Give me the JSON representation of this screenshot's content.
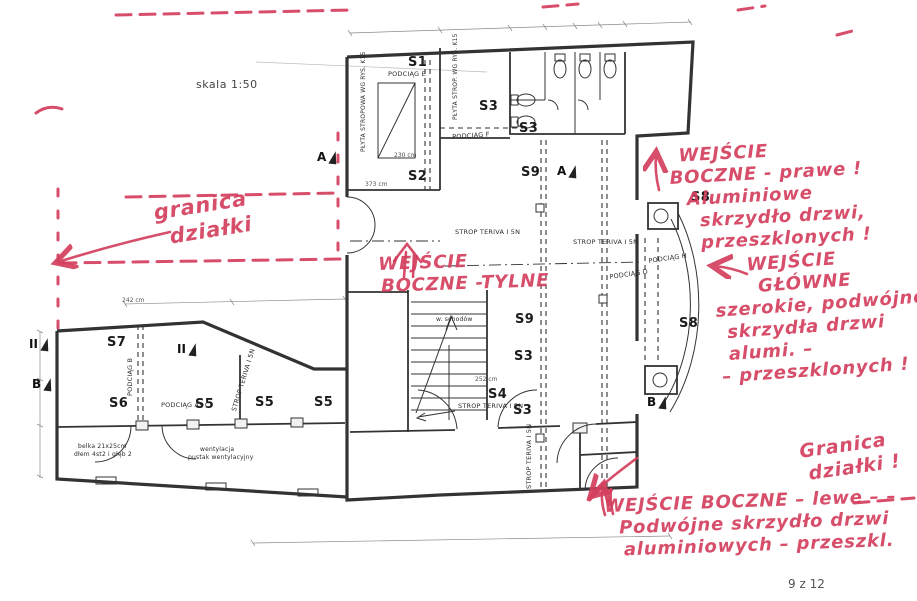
{
  "meta": {
    "scale_label": "skala 1:50",
    "page_number": "9 z 12"
  },
  "colors": {
    "marker_red": "#d43f5e",
    "ink": "#333333",
    "paper": "#ffffff"
  },
  "plan": {
    "room_labels": [
      {
        "label": "S1",
        "x": 408,
        "y": 55
      },
      {
        "label": "S2",
        "x": 408,
        "y": 169
      },
      {
        "label": "S3",
        "x": 479,
        "y": 99
      },
      {
        "label": "S3",
        "x": 519,
        "y": 121
      },
      {
        "label": "S9",
        "x": 521,
        "y": 165
      },
      {
        "label": "S9",
        "x": 515,
        "y": 312
      },
      {
        "label": "S3",
        "x": 514,
        "y": 349
      },
      {
        "label": "S4",
        "x": 488,
        "y": 387
      },
      {
        "label": "S3",
        "x": 513,
        "y": 403
      },
      {
        "label": "S8",
        "x": 691,
        "y": 190
      },
      {
        "label": "S8",
        "x": 679,
        "y": 316
      },
      {
        "label": "S7",
        "x": 107,
        "y": 335
      },
      {
        "label": "S6",
        "x": 109,
        "y": 396
      },
      {
        "label": "S5",
        "x": 195,
        "y": 397
      },
      {
        "label": "S5",
        "x": 255,
        "y": 395
      },
      {
        "label": "S5",
        "x": 314,
        "y": 395
      }
    ],
    "tech_labels": [
      {
        "text": "PODCIĄG E",
        "x": 388,
        "y": 70
      },
      {
        "text": "PODCIĄG F",
        "x": 452,
        "y": 133,
        "rotate": -4
      },
      {
        "text": "PŁYTA STROPOWA WG RYS. K15",
        "x": 360,
        "y": 152,
        "rotate": -90,
        "size": 6
      },
      {
        "text": "PŁYTA STROP. WG RYS. K15",
        "x": 452,
        "y": 120,
        "rotate": -90,
        "size": 6
      },
      {
        "text": "PODCIĄG B",
        "x": 126,
        "y": 396,
        "rotate": -90
      },
      {
        "text": "PODCIĄG A+C",
        "x": 161,
        "y": 401
      },
      {
        "text": "STROP TERIVA I 5N",
        "x": 230,
        "y": 410,
        "rotate": -73
      },
      {
        "text": "STROP TERIVA I 5N",
        "x": 455,
        "y": 228
      },
      {
        "text": "STROP TERIVA I 5N",
        "x": 573,
        "y": 238
      },
      {
        "text": "STROP TERIVA I 5N",
        "x": 458,
        "y": 402
      },
      {
        "text": "STROP TERIVA I 5N",
        "x": 525,
        "y": 489,
        "rotate": -90
      },
      {
        "text": "PODCIĄG D",
        "x": 609,
        "y": 273,
        "rotate": -8
      },
      {
        "text": "PODCIĄG H",
        "x": 648,
        "y": 257,
        "rotate": -8
      },
      {
        "text": "w. schodów",
        "x": 436,
        "y": 316,
        "size": 6
      },
      {
        "text": "wentylacja",
        "x": 200,
        "y": 446,
        "size": 6
      },
      {
        "text": "pustak wentylacyjny",
        "x": 188,
        "y": 454,
        "size": 6
      },
      {
        "text": "belka 21x25cm",
        "x": 78,
        "y": 443,
        "size": 6
      },
      {
        "text": "dłem 4st2 i głęb 2",
        "x": 74,
        "y": 451,
        "size": 6
      }
    ],
    "dim_labels": [
      {
        "text": "242 cm",
        "x": 122,
        "y": 297
      },
      {
        "text": "230 cm",
        "x": 394,
        "y": 152
      },
      {
        "text": "373 cm",
        "x": 365,
        "y": 181
      },
      {
        "text": "252 cm",
        "x": 475,
        "y": 376
      }
    ],
    "section_markers": [
      {
        "label": "A",
        "x": 317,
        "y": 150
      },
      {
        "label": "A",
        "x": 557,
        "y": 164
      },
      {
        "label": "II",
        "x": 29,
        "y": 337
      },
      {
        "label": "II",
        "x": 177,
        "y": 342
      },
      {
        "label": "B",
        "x": 32,
        "y": 377
      },
      {
        "label": "B",
        "x": 647,
        "y": 395
      }
    ]
  },
  "annotations": {
    "notes": [
      {
        "id": "note-granica-dzialki-left",
        "x": 152,
        "y": 201,
        "rotate": -9,
        "size": 21,
        "lines": [
          {
            "text": "granica",
            "indent": 0
          },
          {
            "text": "działki",
            "indent": 12
          }
        ]
      },
      {
        "id": "note-wejscie-boczne-tylne",
        "x": 378,
        "y": 254,
        "rotate": -2,
        "size": 18,
        "lines": [
          {
            "text": "WEJŚCIE",
            "indent": 0
          },
          {
            "text": "BOCZNE -TYLNE",
            "indent": 2
          }
        ]
      },
      {
        "id": "note-wejscie-boczne-prawe",
        "x": 668,
        "y": 146,
        "rotate": -3,
        "size": 18,
        "lines": [
          {
            "text": "WEJŚCIE",
            "indent": 10
          },
          {
            "text": "BOCZNE - prawe !",
            "indent": 0
          },
          {
            "text": "Aluminiowe",
            "indent": 16
          },
          {
            "text": "skrzydło drzwi,",
            "indent": 28
          },
          {
            "text": "przeszklonych !",
            "indent": 28
          }
        ]
      },
      {
        "id": "note-wejscie-glowne",
        "x": 712,
        "y": 257,
        "rotate": -4,
        "size": 18,
        "lines": [
          {
            "text": "WEJŚCIE",
            "indent": 34
          },
          {
            "text": "GŁÓWNE",
            "indent": 44
          },
          {
            "text": "szerokie, podwójne",
            "indent": 0
          },
          {
            "text": "skrzydła drzwi",
            "indent": 10
          },
          {
            "text": "alumi. –",
            "indent": 10
          },
          {
            "text": "– przeszklonych !",
            "indent": 2
          }
        ]
      },
      {
        "id": "note-granica-dzialki-bottom",
        "x": 798,
        "y": 441,
        "rotate": -8,
        "size": 19,
        "lines": [
          {
            "text": "Granica",
            "indent": 0
          },
          {
            "text": "działki !",
            "indent": 6
          }
        ]
      },
      {
        "id": "note-wejscie-boczne-lewe",
        "x": 604,
        "y": 496,
        "rotate": -2,
        "size": 18,
        "lines": [
          {
            "text": "WEJŚCIE BOCZNE – lewe – –",
            "indent": 0
          },
          {
            "text": "Podwójne skrzydło drzwi",
            "indent": 14
          },
          {
            "text": "aluminiowych – przeszkl.",
            "indent": 18
          }
        ]
      }
    ]
  }
}
